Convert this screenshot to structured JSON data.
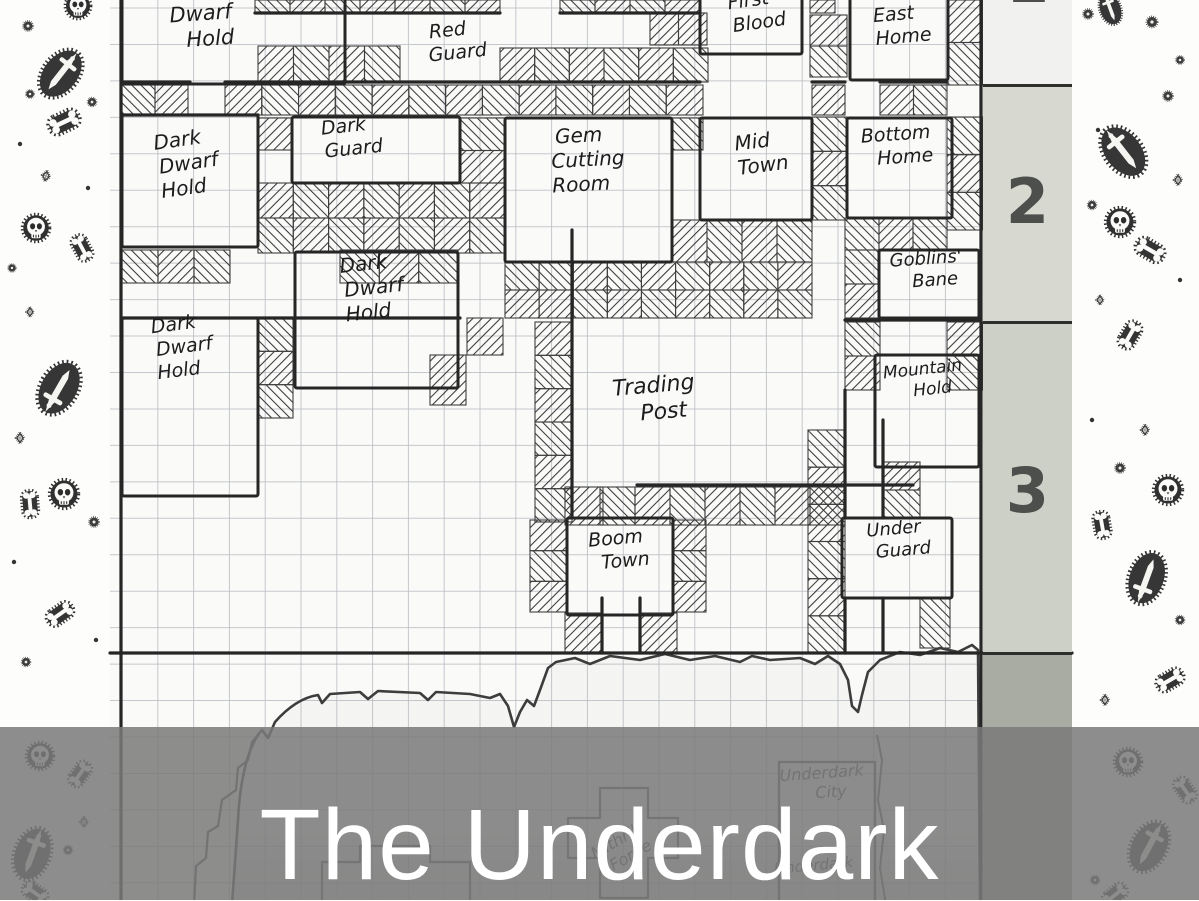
{
  "title": {
    "text": "The Underdark"
  },
  "sidebar": {
    "sections": [
      {
        "num": "1"
      },
      {
        "num": "2"
      },
      {
        "num": "3"
      },
      {
        "num": ""
      }
    ]
  },
  "colors": {
    "ink": "#262626",
    "grid": "#b9bcc2",
    "paper": "#fafaf8",
    "pencil": "#555555",
    "overlay": "rgba(122,122,122,0.86)",
    "title_text": "#ffffff",
    "sidebar_s1": "#f1f1ef",
    "sidebar_s2": "#d7d9d1",
    "sidebar_s3": "#cdd0c7",
    "sidebar_s4": "#a9aca3"
  },
  "map": {
    "rooms": [
      {
        "id": "dwarf-hold",
        "box": [
          122,
          -8,
          223,
          92
        ],
        "lines": [
          "Dwarf",
          "Hold"
        ],
        "lx": 205,
        "ly": 20,
        "rot": -4,
        "fs": 21
      },
      {
        "id": "red-guard",
        "box": null,
        "lines": [
          "Red",
          "Guard"
        ],
        "lx": 452,
        "ly": 36,
        "rot": -6,
        "fs": 19
      },
      {
        "id": "first-blood",
        "box": [
          700,
          -8,
          102,
          62
        ],
        "lines": [
          "First",
          "Blood"
        ],
        "lx": 753,
        "ly": 6,
        "rot": -8,
        "fs": 19
      },
      {
        "id": "east-home",
        "box": [
          850,
          -8,
          98,
          88
        ],
        "lines": [
          "East",
          "Home"
        ],
        "lx": 898,
        "ly": 20,
        "rot": -5,
        "fs": 19
      },
      {
        "id": "dark-dwarf-hold-1",
        "box": [
          122,
          115,
          136,
          132
        ],
        "lines": [
          "Dark",
          "Dwarf",
          "Hold"
        ],
        "lx": 182,
        "ly": 146,
        "rot": -8,
        "fs": 20
      },
      {
        "id": "dark-guard",
        "box": [
          292,
          117,
          168,
          66
        ],
        "lines": [
          "Dark",
          "Guard"
        ],
        "lx": 348,
        "ly": 132,
        "rot": -6,
        "fs": 19
      },
      {
        "id": "gem-cutting-room",
        "box": [
          505,
          118,
          167,
          144
        ],
        "lines": [
          "Gem",
          "Cutting",
          "Room"
        ],
        "lx": 583,
        "ly": 142,
        "rot": -3,
        "fs": 20
      },
      {
        "id": "mid-town",
        "box": [
          700,
          118,
          112,
          102
        ],
        "lines": [
          "Mid",
          "Town"
        ],
        "lx": 757,
        "ly": 148,
        "rot": -7,
        "fs": 20
      },
      {
        "id": "bottom-home",
        "box": [
          847,
          118,
          105,
          100
        ],
        "lines": [
          "Bottom",
          "Home"
        ],
        "lx": 900,
        "ly": 140,
        "rot": -4,
        "fs": 19
      },
      {
        "id": "goblins-bane",
        "box": [
          879,
          250,
          100,
          68
        ],
        "lines": [
          "Goblins'",
          "Bane"
        ],
        "lx": 930,
        "ly": 264,
        "rot": -4,
        "fs": 18
      },
      {
        "id": "dark-dwarf-hold-2",
        "box": [
          122,
          318,
          136,
          178
        ],
        "lines": [
          "Dark",
          "Dwarf",
          "Hold"
        ],
        "lx": 178,
        "ly": 330,
        "rot": -7,
        "fs": 19
      },
      {
        "id": "dark-dwarf-hold-3",
        "box": [
          295,
          252,
          163,
          136
        ],
        "lines": [
          "Dark",
          "Dwarf",
          "Hold"
        ],
        "lx": 368,
        "ly": 270,
        "rot": -6,
        "fs": 20
      },
      {
        "id": "trading-post",
        "box": null,
        "lines": [
          "Trading",
          "Post"
        ],
        "lx": 658,
        "ly": 392,
        "rot": -5,
        "fs": 22
      },
      {
        "id": "mountain-hold",
        "box": [
          875,
          355,
          104,
          112
        ],
        "lines": [
          "Mountain",
          "Hold"
        ],
        "lx": 927,
        "ly": 374,
        "rot": -6,
        "fs": 17
      },
      {
        "id": "boom-town",
        "box": [
          567,
          518,
          106,
          97
        ],
        "lines": [
          "Boom",
          "Town"
        ],
        "lx": 620,
        "ly": 544,
        "rot": -5,
        "fs": 19
      },
      {
        "id": "under-guard",
        "box": [
          842,
          518,
          110,
          80
        ],
        "lines": [
          "Under",
          "Guard"
        ],
        "lx": 898,
        "ly": 534,
        "rot": -5,
        "fs": 18
      }
    ],
    "cavern_labels": [
      {
        "id": "underdark-city",
        "lines": [
          "Underdark",
          "City"
        ],
        "lx": 826,
        "ly": 778,
        "rot": -4,
        "fs": 16
      },
      {
        "id": "mithril-forge",
        "lines": [
          "Mithril",
          "Forge"
        ],
        "lx": 620,
        "ly": 845,
        "rot": -30,
        "fs": 16
      },
      {
        "id": "underdark-lower",
        "lines": [
          "Underdark"
        ],
        "lx": 818,
        "ly": 870,
        "rot": -5,
        "fs": 15
      }
    ],
    "hatches": [
      [
        255,
        0,
        245,
        13
      ],
      [
        560,
        0,
        140,
        13
      ],
      [
        810,
        0,
        25,
        13
      ],
      [
        650,
        13,
        57,
        32
      ],
      [
        810,
        15,
        37,
        62
      ],
      [
        947,
        0,
        36,
        85
      ],
      [
        258,
        46,
        142,
        36
      ],
      [
        500,
        48,
        208,
        34
      ],
      [
        122,
        85,
        66,
        30
      ],
      [
        225,
        85,
        478,
        30
      ],
      [
        812,
        85,
        33,
        30
      ],
      [
        880,
        85,
        67,
        30
      ],
      [
        258,
        118,
        34,
        32
      ],
      [
        460,
        118,
        45,
        65
      ],
      [
        672,
        118,
        31,
        32
      ],
      [
        812,
        117,
        35,
        103
      ],
      [
        947,
        117,
        36,
        113
      ],
      [
        258,
        183,
        247,
        70
      ],
      [
        672,
        220,
        140,
        42
      ],
      [
        505,
        262,
        307,
        56
      ],
      [
        845,
        218,
        102,
        32
      ],
      [
        845,
        250,
        34,
        68
      ],
      [
        122,
        250,
        108,
        33
      ],
      [
        340,
        250,
        118,
        33
      ],
      [
        258,
        318,
        35,
        100
      ],
      [
        467,
        318,
        36,
        37
      ],
      [
        430,
        355,
        36,
        50
      ],
      [
        535,
        322,
        37,
        200
      ],
      [
        845,
        322,
        35,
        68
      ],
      [
        947,
        322,
        36,
        68
      ],
      [
        808,
        430,
        37,
        223
      ],
      [
        883,
        462,
        37,
        56
      ],
      [
        565,
        487,
        38,
        38
      ],
      [
        600,
        487,
        245,
        38
      ],
      [
        530,
        520,
        37,
        92
      ],
      [
        673,
        520,
        33,
        92
      ],
      [
        565,
        613,
        37,
        40
      ],
      [
        640,
        613,
        37,
        40
      ],
      [
        920,
        598,
        30,
        50
      ]
    ],
    "walls": [
      [
        122,
        82,
        190,
        82
      ],
      [
        225,
        82,
        700,
        82
      ],
      [
        812,
        82,
        845,
        82
      ],
      [
        880,
        82,
        947,
        82
      ],
      [
        122,
        115,
        258,
        115
      ],
      [
        122,
        318,
        460,
        318
      ],
      [
        845,
        320,
        981,
        320
      ],
      [
        110,
        653,
        1072,
        653
      ],
      [
        572,
        230,
        572,
        518
      ],
      [
        602,
        598,
        602,
        653
      ],
      [
        640,
        598,
        640,
        653
      ],
      [
        845,
        390,
        845,
        518
      ],
      [
        845,
        598,
        845,
        653
      ],
      [
        883,
        420,
        883,
        518
      ],
      [
        883,
        598,
        883,
        653
      ],
      [
        637,
        485,
        913,
        485
      ],
      [
        255,
        13,
        500,
        13
      ],
      [
        560,
        13,
        700,
        13
      ],
      [
        121,
        0,
        121,
        900
      ],
      [
        981,
        0,
        981,
        900
      ]
    ]
  },
  "borders": {
    "motif_types": [
      "skull-icon",
      "bone-icon",
      "dagger-icon",
      "gem-icon",
      "gear-icon",
      "dot-icon"
    ]
  }
}
